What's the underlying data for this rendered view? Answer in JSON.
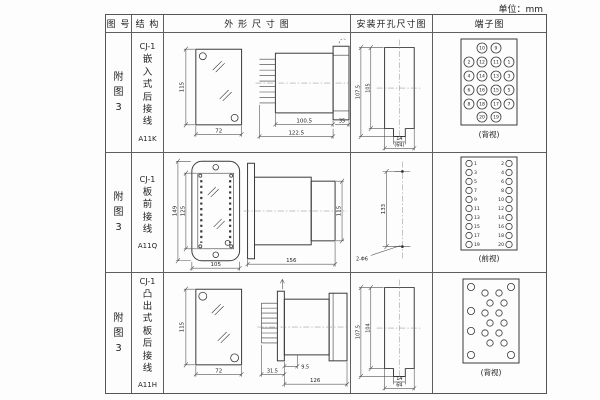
{
  "unit_label": "单位：mm",
  "header": {
    "figure": "图 号",
    "structure": "结 构",
    "outline": "外 形 尺 寸 图",
    "mounting": "安装开孔尺寸图",
    "terminal": "端子图"
  },
  "rows": [
    {
      "figure": "附图3",
      "model": "CJ-1",
      "type": "嵌入式后接线",
      "code": "A11K",
      "outline": {
        "front_h": "115",
        "front_w": "72",
        "body_l": "100.5",
        "total_l": "122.5",
        "flange_w": "35"
      },
      "mounting": {
        "outer_h": "107.5",
        "inner_h": "105",
        "notch_w": "14",
        "total_w": "(64)"
      },
      "terminal": {
        "caption": "(背视)",
        "rows": [
          [
            "10",
            "9"
          ],
          [
            "2",
            "12",
            "11",
            "1"
          ],
          [
            "4",
            "14",
            "13",
            "3"
          ],
          [
            "6",
            "16",
            "15",
            "5"
          ],
          [
            "8",
            "18",
            "17",
            "7"
          ],
          [
            "20",
            "19"
          ]
        ]
      }
    },
    {
      "figure": "附图3",
      "model": "CJ-1",
      "type": "板前接线",
      "code": "A11Q",
      "outline": {
        "outer_h": "149",
        "inner_h": "125",
        "front_w": "105",
        "side_l": "156",
        "side_h": "115"
      },
      "mounting": {
        "hole_dist": "133",
        "hole_label": "2-Φ6"
      },
      "terminal": {
        "caption": "(前视)",
        "left": [
          "1",
          "3",
          "5",
          "7",
          "9",
          "11",
          "13",
          "15",
          "17",
          "19"
        ],
        "right": [
          "2",
          "4",
          "6",
          "8",
          "10",
          "12",
          "14",
          "16",
          "18",
          "20"
        ]
      }
    },
    {
      "figure": "附图3",
      "model": "CJ-1",
      "type": "凸出式板后接线",
      "code": "A11H",
      "outline": {
        "front_h": "115",
        "front_w": "72",
        "pin_d": "31.5",
        "step_d": "9.5",
        "body_l": "126"
      },
      "mounting": {
        "outer_h": "107.5",
        "inner_h": "104",
        "notch_w": "14",
        "total_w": "64"
      },
      "terminal": {
        "caption": "(背视)"
      }
    }
  ]
}
